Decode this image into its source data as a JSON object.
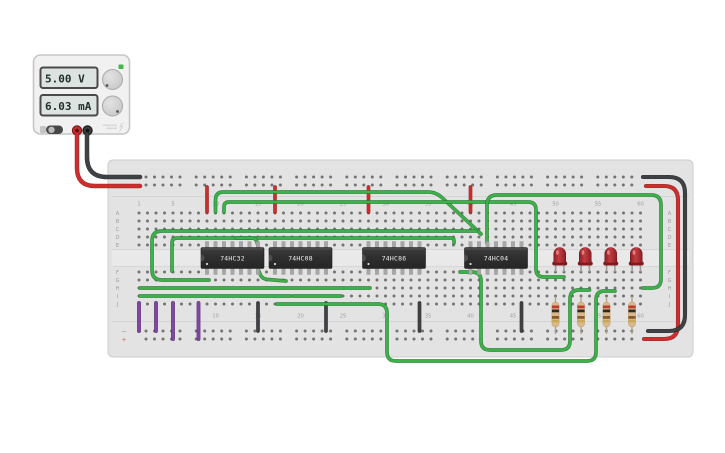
{
  "app": {
    "background": "#ffffff"
  },
  "power_supply": {
    "voltage_display": "5.00 V",
    "current_display": "6.03 mA",
    "indicator_color": "#43b649",
    "positive_terminal_color": "#c62f2f",
    "negative_terminal_color": "#3d3d3d"
  },
  "breadboard": {
    "column_label_cols": [
      1,
      5,
      10,
      15,
      20,
      25,
      30,
      35,
      40,
      45,
      50,
      55,
      60
    ],
    "row_letters_top": [
      "A",
      "B",
      "C",
      "D",
      "E"
    ],
    "row_letters_bottom": [
      "F",
      "G",
      "H",
      "I",
      "J"
    ],
    "plus_mark": "+",
    "minus_mark": "−"
  },
  "ics": [
    {
      "name": "ic-74hc32",
      "label": "74HC32",
      "start_col": 9
    },
    {
      "name": "ic-74hc08",
      "label": "74HC08",
      "start_col": 17
    },
    {
      "name": "ic-74hc86",
      "label": "74HC86",
      "start_col": 28
    },
    {
      "name": "ic-74hc04",
      "label": "74HC04",
      "start_col": 40
    }
  ],
  "leds": [
    {
      "name": "led-1",
      "cathode_col": 50,
      "color": "red"
    },
    {
      "name": "led-2",
      "cathode_col": 53,
      "color": "red"
    },
    {
      "name": "led-3",
      "cathode_col": 56,
      "color": "red"
    },
    {
      "name": "led-4",
      "cathode_col": 59,
      "color": "red"
    }
  ],
  "resistors": [
    {
      "name": "resistor-1",
      "col": 50,
      "bands": [
        "#c03a2e",
        "#2e2a26",
        "#8a5a2a",
        "#c9a959"
      ]
    },
    {
      "name": "resistor-2",
      "col": 53,
      "bands": [
        "#c03a2e",
        "#2e2a26",
        "#8a5a2a",
        "#c9a959"
      ]
    },
    {
      "name": "resistor-3",
      "col": 56,
      "bands": [
        "#c03a2e",
        "#2e2a26",
        "#8a5a2a",
        "#c9a959"
      ]
    },
    {
      "name": "resistor-4",
      "col": 59,
      "bands": [
        "#c03a2e",
        "#2e2a26",
        "#8a5a2a",
        "#c9a959"
      ]
    }
  ],
  "wire_colors": {
    "green": [
      "#3cb24a",
      "#2a7d34"
    ],
    "red": [
      "#d12b2b",
      "#9c1c1c"
    ],
    "black": [
      "#3f4244",
      "#222528"
    ],
    "purple": [
      "#8246a5",
      "#5b2f77"
    ]
  },
  "wires": [
    {
      "name": "wire-supply-positive",
      "color": "red",
      "w": 3.0,
      "r": 18,
      "points": [
        [
          77,
          134
        ],
        [
          77,
          186
        ],
        [
          140,
          186
        ]
      ]
    },
    {
      "name": "wire-supply-negative",
      "color": "black",
      "w": 3.0,
      "r": 20,
      "points": [
        [
          87,
          134
        ],
        [
          87,
          177
        ],
        [
          140,
          177
        ]
      ]
    },
    {
      "name": "wire-vcc-ic1",
      "color": "red",
      "w": 2.2,
      "r": 4,
      "points": [
        [
          207,
          187
        ],
        [
          207,
          212
        ]
      ]
    },
    {
      "name": "wire-vcc-ic2",
      "color": "red",
      "w": 2.2,
      "r": 4,
      "points": [
        [
          275,
          187
        ],
        [
          275,
          212
        ]
      ]
    },
    {
      "name": "wire-vcc-ic3",
      "color": "red",
      "w": 2.2,
      "r": 4,
      "points": [
        [
          368.5,
          187
        ],
        [
          368.5,
          212
        ]
      ]
    },
    {
      "name": "wire-vcc-ic4",
      "color": "red",
      "w": 2.2,
      "r": 4,
      "points": [
        [
          470.5,
          187
        ],
        [
          470.5,
          212
        ]
      ]
    },
    {
      "name": "wire-rail-bridge-positive",
      "color": "red",
      "w": 2.6,
      "r": 14,
      "points": [
        [
          646,
          186
        ],
        [
          678,
          186
        ],
        [
          678,
          339
        ],
        [
          644,
          339
        ]
      ]
    },
    {
      "name": "wire-rail-bridge-negative",
      "color": "black",
      "w": 2.6,
      "r": 16,
      "points": [
        [
          643,
          177
        ],
        [
          685,
          177
        ],
        [
          685,
          331
        ],
        [
          648,
          331
        ]
      ]
    },
    {
      "name": "wire-gnd-ic1",
      "color": "black",
      "w": 2.2,
      "r": 4,
      "points": [
        [
          258,
          303
        ],
        [
          258,
          331
        ]
      ]
    },
    {
      "name": "wire-gnd-ic2",
      "color": "black",
      "w": 2.2,
      "r": 4,
      "points": [
        [
          326,
          303
        ],
        [
          326,
          331
        ]
      ]
    },
    {
      "name": "wire-gnd-ic3",
      "color": "black",
      "w": 2.2,
      "r": 4,
      "points": [
        [
          419.5,
          303
        ],
        [
          419.5,
          331
        ]
      ]
    },
    {
      "name": "wire-gnd-ic4",
      "color": "black",
      "w": 2.2,
      "r": 4,
      "points": [
        [
          521.5,
          303
        ],
        [
          521.5,
          331
        ]
      ]
    },
    {
      "name": "wire-input-1",
      "color": "purple",
      "w": 2.4,
      "r": 4,
      "points": [
        [
          139,
          303
        ],
        [
          139,
          331
        ]
      ]
    },
    {
      "name": "wire-input-2",
      "color": "purple",
      "w": 2.4,
      "r": 4,
      "points": [
        [
          156,
          303
        ],
        [
          156,
          331
        ]
      ]
    },
    {
      "name": "wire-input-3",
      "color": "purple",
      "w": 2.4,
      "r": 4,
      "points": [
        [
          173,
          303
        ],
        [
          173,
          339
        ]
      ]
    },
    {
      "name": "wire-input-4",
      "color": "purple",
      "w": 2.4,
      "r": 4,
      "points": [
        [
          198.5,
          303
        ],
        [
          198.5,
          339
        ]
      ]
    },
    {
      "name": "wire-signal-1",
      "color": "green",
      "w": 2.2,
      "r": 8,
      "points": [
        [
          215.5,
          212
        ],
        [
          215.5,
          192
        ],
        [
          436,
          192
        ],
        [
          481,
          234
        ]
      ]
    },
    {
      "name": "wire-signal-2",
      "color": "green",
      "w": 2.2,
      "r": 8,
      "points": [
        [
          224,
          212
        ],
        [
          224,
          202
        ],
        [
          536,
          202
        ],
        [
          536,
          277
        ],
        [
          564,
          277
        ]
      ]
    },
    {
      "name": "wire-signal-3",
      "color": "green",
      "w": 2.2,
      "r": 10,
      "points": [
        [
          487,
          243
        ],
        [
          487,
          195
        ],
        [
          661,
          195
        ],
        [
          661,
          288
        ],
        [
          643,
          288
        ]
      ]
    },
    {
      "name": "wire-signal-4",
      "color": "green",
      "w": 2.2,
      "r": 10,
      "points": [
        [
          476,
          231
        ],
        [
          152,
          231
        ],
        [
          152,
          280
        ],
        [
          209,
          280
        ]
      ]
    },
    {
      "name": "wire-signal-5",
      "color": "green",
      "w": 2.2,
      "r": 5,
      "points": [
        [
          454,
          243
        ],
        [
          454,
          238
        ],
        [
          172,
          238
        ],
        [
          172,
          271
        ]
      ]
    },
    {
      "name": "wire-signal-6",
      "color": "green",
      "w": 2.2,
      "r": 4,
      "points": [
        [
          140,
          288
        ],
        [
          370,
          288
        ]
      ]
    },
    {
      "name": "wire-signal-7",
      "color": "green",
      "w": 2.2,
      "r": 4,
      "points": [
        [
          140,
          296
        ],
        [
          290,
          296
        ]
      ]
    },
    {
      "name": "wire-signal-8",
      "color": "green",
      "w": 2.2,
      "r": 4,
      "points": [
        [
          293,
          296
        ],
        [
          341,
          296
        ]
      ]
    },
    {
      "name": "wire-signal-9",
      "color": "green",
      "w": 2.2,
      "r": 6,
      "points": [
        [
          258,
          269
        ],
        [
          262,
          279
        ],
        [
          286,
          281
        ]
      ]
    },
    {
      "name": "wire-signal-10",
      "color": "green",
      "w": 2.2,
      "r": 9,
      "points": [
        [
          277,
          304
        ],
        [
          387,
          304
        ],
        [
          387,
          361
        ],
        [
          596,
          361
        ],
        [
          596,
          291
        ],
        [
          615,
          291
        ]
      ]
    },
    {
      "name": "wire-signal-11",
      "color": "green",
      "w": 2.2,
      "r": 9,
      "points": [
        [
          460,
          272
        ],
        [
          481,
          272
        ],
        [
          481,
          350
        ],
        [
          570,
          350
        ],
        [
          570,
          290
        ],
        [
          589.5,
          290
        ]
      ]
    },
    {
      "name": "wire-signal-12",
      "color": "green",
      "w": 2.2,
      "r": 5,
      "points": [
        [
          236,
          238
        ],
        [
          256,
          238
        ],
        [
          258,
          246
        ]
      ]
    }
  ]
}
